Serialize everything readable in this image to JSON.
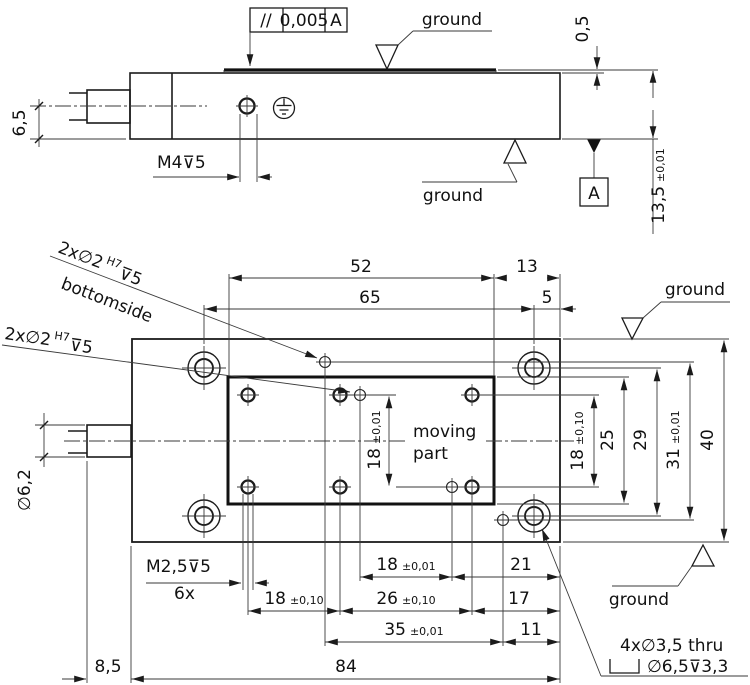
{
  "colors": {
    "background": "#ffffff",
    "line": "#1b1b1b",
    "text": "#111111"
  },
  "top_view": {
    "fcf": {
      "symbol": "//",
      "value": "0,005",
      "datum": "A"
    },
    "ground_top": "ground",
    "ground_bottom": "ground",
    "datum": "A",
    "dim_6_5": "6,5",
    "dim_m4": "M4⊽5",
    "dim_0_5": "0,5",
    "dim_13_5": "13,5",
    "dim_13_5_tol": "±0,01"
  },
  "bottom_view": {
    "leader_bottomside": {
      "main": "2x∅2",
      "fit": "H7",
      "depth": "⊽5",
      "note": "bottomside"
    },
    "leader_topside": {
      "main": "2x∅2",
      "fit": "H7",
      "depth": "⊽5"
    },
    "moving_part": {
      "line1": "moving",
      "line2": "part"
    },
    "tapped": {
      "thread": "M2,5⊽5",
      "count": "6x"
    },
    "mounting": {
      "line1": "4x∅3,5 thru",
      "line2": "∅6,5⊽3,3"
    },
    "ground_top": "ground",
    "ground_bottom": "ground",
    "dim_52": "52",
    "dim_13": "13",
    "dim_65": "65",
    "dim_5": "5",
    "dim_18v": {
      "v": "18",
      "tol": "±0,01"
    },
    "dim_18r": {
      "v": "18",
      "tol": "±0,10"
    },
    "dim_25": "25",
    "dim_29": "29",
    "dim_31": {
      "v": "31",
      "tol": "±0,01"
    },
    "dim_40": "40",
    "dim_18h": {
      "v": "18",
      "tol": "±0,01"
    },
    "dim_21": "21",
    "dim_17": "17",
    "dim_11": "11",
    "dim_18b": {
      "v": "18",
      "tol": "±0,10"
    },
    "dim_26": {
      "v": "26",
      "tol": "±0,10"
    },
    "dim_35": {
      "v": "35",
      "tol": "±0,01"
    },
    "dim_6_2": "∅6,2",
    "dim_8_5": "8,5",
    "dim_84": "84"
  }
}
